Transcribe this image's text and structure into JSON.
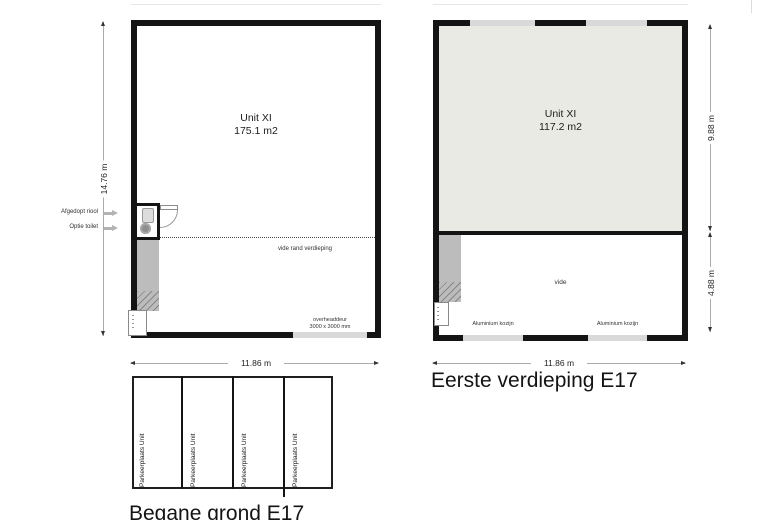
{
  "ground_floor": {
    "title": "Begane grond E17",
    "unit": {
      "name": "Unit XI",
      "area": "175.1 m2"
    },
    "dims": {
      "width": "11.86 m",
      "height": "14.76 m"
    },
    "labels": {
      "vide": "vide rand verdieping",
      "overhead_door": "overheaddeur",
      "overhead_door_size": "3000 x 3000 mm",
      "sewer": "Afgedopt riool",
      "toilet_option": "Optie toilet"
    },
    "parking": {
      "stalls": [
        {
          "label": "Parkeerplaats Unit"
        },
        {
          "label": "Parkeerplaats Unit"
        },
        {
          "label": "Parkeerplaats Unit"
        },
        {
          "label": "Parkeerplaats Unit"
        }
      ]
    }
  },
  "first_floor": {
    "title": "Eerste verdieping E17",
    "unit": {
      "name": "Unit XI",
      "area": "117.2 m2"
    },
    "dims": {
      "width": "11.86 m",
      "upper_height": "9.88 m",
      "lower_height": "4.88 m"
    },
    "labels": {
      "vide": "vide",
      "window_left": "Aluminium kozijn",
      "window_right": "Aluminium kozijn"
    }
  },
  "colors": {
    "wall": "#141414",
    "stairs": "#bcbcbc",
    "window_glass": "#d9d9d9",
    "upper_floor_fill": "#eaeae4",
    "dimension_line": "#ababab"
  }
}
